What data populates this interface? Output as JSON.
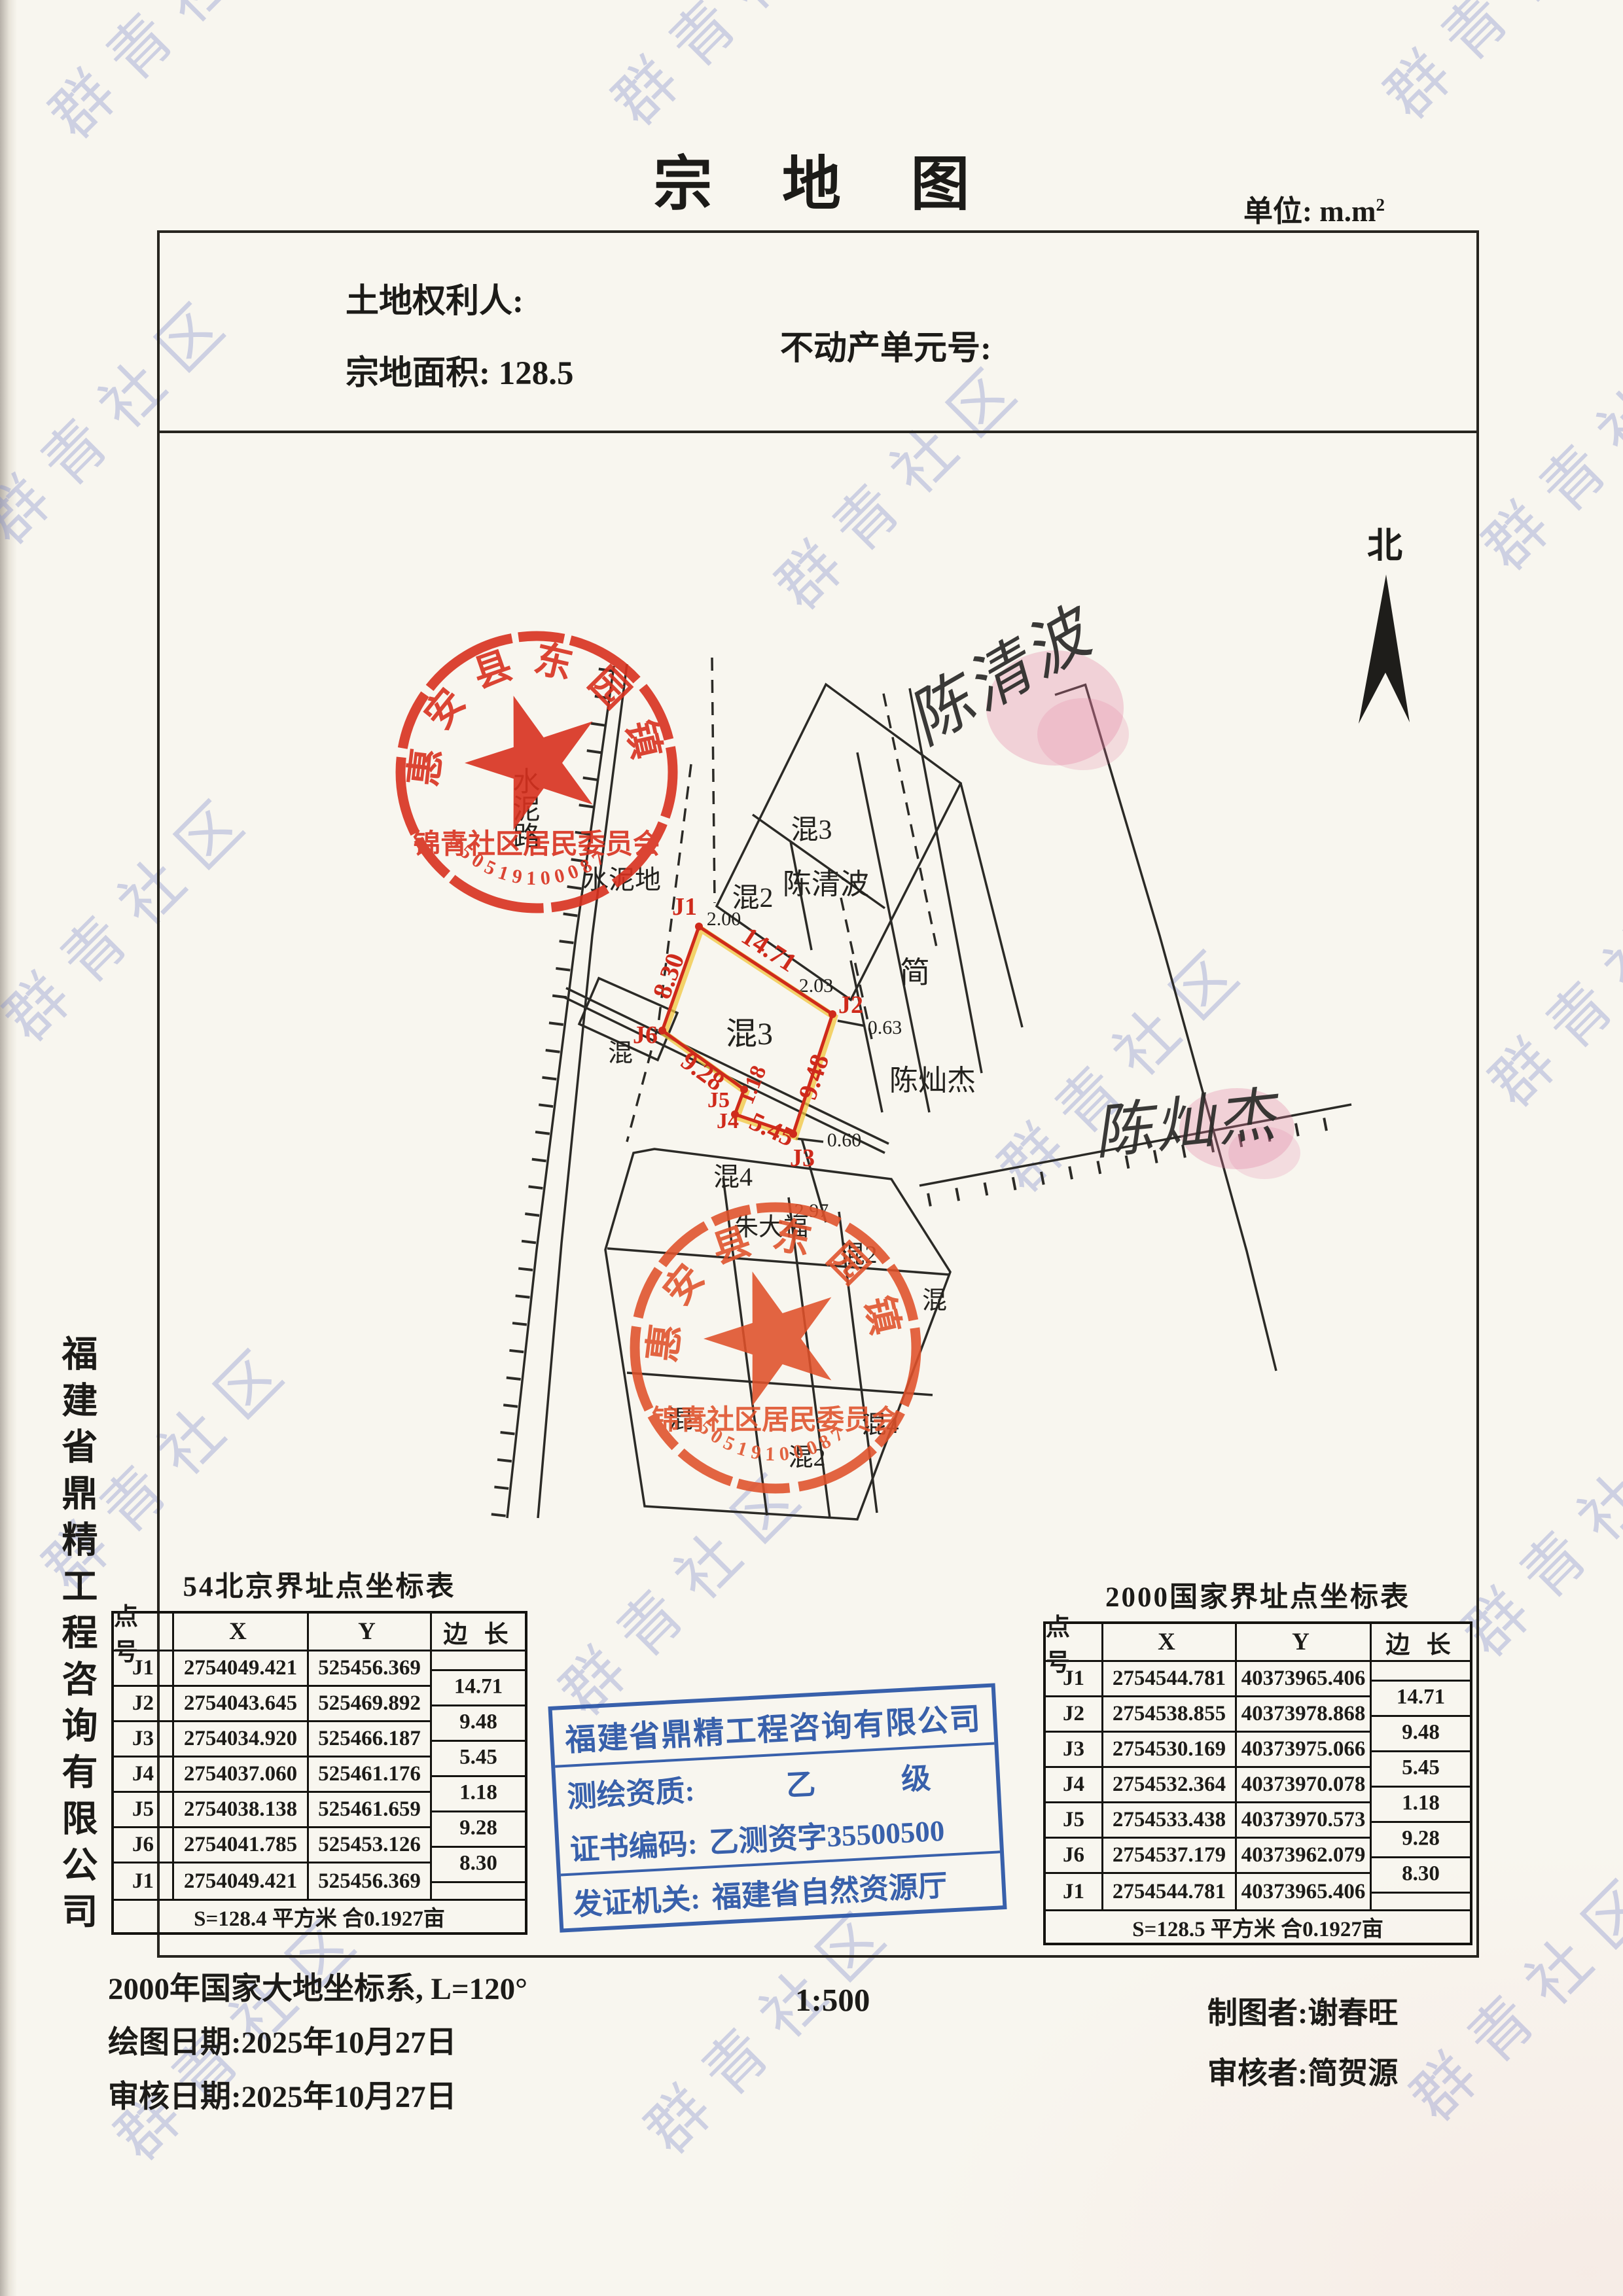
{
  "header": {
    "title": "宗 地 图",
    "unit_label": "单位: m.m",
    "unit_sup": "2",
    "owner_label": "土地权利人:",
    "area_label": "宗地面积:",
    "area_value": "128.5",
    "unit_no": "不动产单元号:"
  },
  "watermark": {
    "text": "群青社区"
  },
  "side_company": "福建省鼎精工程咨询有限公司",
  "map": {
    "north_label": "北",
    "points": [
      "J1",
      "J2",
      "J3",
      "J4",
      "J5",
      "J6"
    ],
    "edge_lengths": [
      "14.71",
      "9.48",
      "5.45",
      "1.18",
      "9.28",
      "8.30"
    ],
    "offsets": {
      "j1": "2.00",
      "j2": "2.03",
      "j2b": "0.63",
      "j3b": "0.60",
      "j4": "2.97"
    },
    "labels": {
      "parcel": "混3",
      "top_building": "混3",
      "top_owner": "陈清波",
      "mix2": "混2",
      "right_owner": "简",
      "east_owner": "陈灿杰",
      "mix4": "混4",
      "zhu": "朱大福",
      "mix2b": "混2",
      "mix_a": "混",
      "mix_b": "混",
      "mix_c": "混",
      "mix4b": "混4",
      "mix2c": "混2",
      "cement_ground": "水泥地",
      "cement_road": "水泥路"
    },
    "signatures": {
      "top": "陈清波",
      "right": "陈灿杰"
    }
  },
  "stamps": {
    "village": {
      "ring_text": "惠安县东园镇",
      "line_text": "锦青社区居民委员会",
      "number": "350519100087"
    }
  },
  "blue_stamp": {
    "company": "福建省鼎精工程咨询有限公司",
    "qualification_label": "测绘资质:",
    "qualification_value": "乙 级",
    "cert_label": "证书编码:",
    "cert_value": "乙测资字35500500",
    "issuer_label": "发证机关:",
    "issuer_value": "福建省自然资源厅"
  },
  "tables": {
    "left": {
      "title": "54北京界址点坐标表",
      "headers": [
        "点 号",
        "X",
        "Y",
        "边 长"
      ],
      "rows": [
        [
          "J1",
          "2754049.421",
          "525456.369"
        ],
        [
          "J2",
          "2754043.645",
          "525469.892"
        ],
        [
          "J3",
          "2754034.920",
          "525466.187"
        ],
        [
          "J4",
          "2754037.060",
          "525461.176"
        ],
        [
          "J5",
          "2754038.138",
          "525461.659"
        ],
        [
          "J6",
          "2754041.785",
          "525453.126"
        ],
        [
          "J1",
          "2754049.421",
          "525456.369"
        ]
      ],
      "edges": [
        "14.71",
        "9.48",
        "5.45",
        "1.18",
        "9.28",
        "8.30"
      ],
      "summary": "S=128.4 平方米 合0.1927亩"
    },
    "right": {
      "title": "2000国家界址点坐标表",
      "headers": [
        "点 号",
        "X",
        "Y",
        "边 长"
      ],
      "rows": [
        [
          "J1",
          "2754544.781",
          "40373965.406"
        ],
        [
          "J2",
          "2754538.855",
          "40373978.868"
        ],
        [
          "J3",
          "2754530.169",
          "40373975.066"
        ],
        [
          "J4",
          "2754532.364",
          "40373970.078"
        ],
        [
          "J5",
          "2754533.438",
          "40373970.573"
        ],
        [
          "J6",
          "2754537.179",
          "40373962.079"
        ],
        [
          "J1",
          "2754544.781",
          "40373965.406"
        ]
      ],
      "edges": [
        "14.71",
        "9.48",
        "5.45",
        "1.18",
        "9.28",
        "8.30"
      ],
      "summary": "S=128.5 平方米 合0.1927亩"
    }
  },
  "footer": {
    "datum": "2000年国家大地坐标系, L=120°",
    "scale": "1:500",
    "draw_date": "绘图日期:2025年10月27日",
    "review_date": "审核日期:2025年10月27日",
    "drafter": "制图者:谢春旺",
    "reviewer": "审核者:简贺源"
  }
}
